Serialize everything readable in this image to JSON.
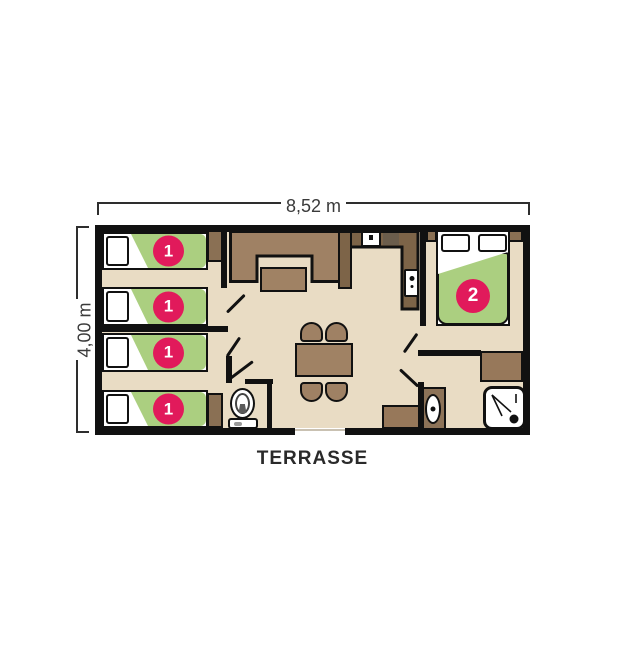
{
  "dimensions": {
    "width": "8,52 m",
    "depth": "4,00 m"
  },
  "labels": {
    "terrace": "TERRASSE"
  },
  "beds": {
    "singles": [
      {
        "badge": "1"
      },
      {
        "badge": "1"
      },
      {
        "badge": "1"
      },
      {
        "badge": "1"
      }
    ],
    "double": {
      "badge": "2"
    }
  },
  "colors": {
    "floor": "#e9dcc4",
    "wall": "#111111",
    "mattress_green": "#abcf80",
    "badge_pink": "#e11a5b",
    "wood_medium": "#9f8164",
    "wood_dark": "#7d6448",
    "wood_light": "#97785a",
    "dim_text": "#3a3a3a"
  },
  "icons": {
    "toilet-icon": "ellipse bowl + tank rectangle",
    "shower-icon": "rounded square + spray lines + drain dot",
    "washbasin-icon": "oval basin + drain dot",
    "sink-icon": "white square + faucet dot",
    "stove-icon": "dark rectangle",
    "appliance-icon": "white rectangle + control dots",
    "door-swing-icon": "diagonal door leaf line"
  }
}
